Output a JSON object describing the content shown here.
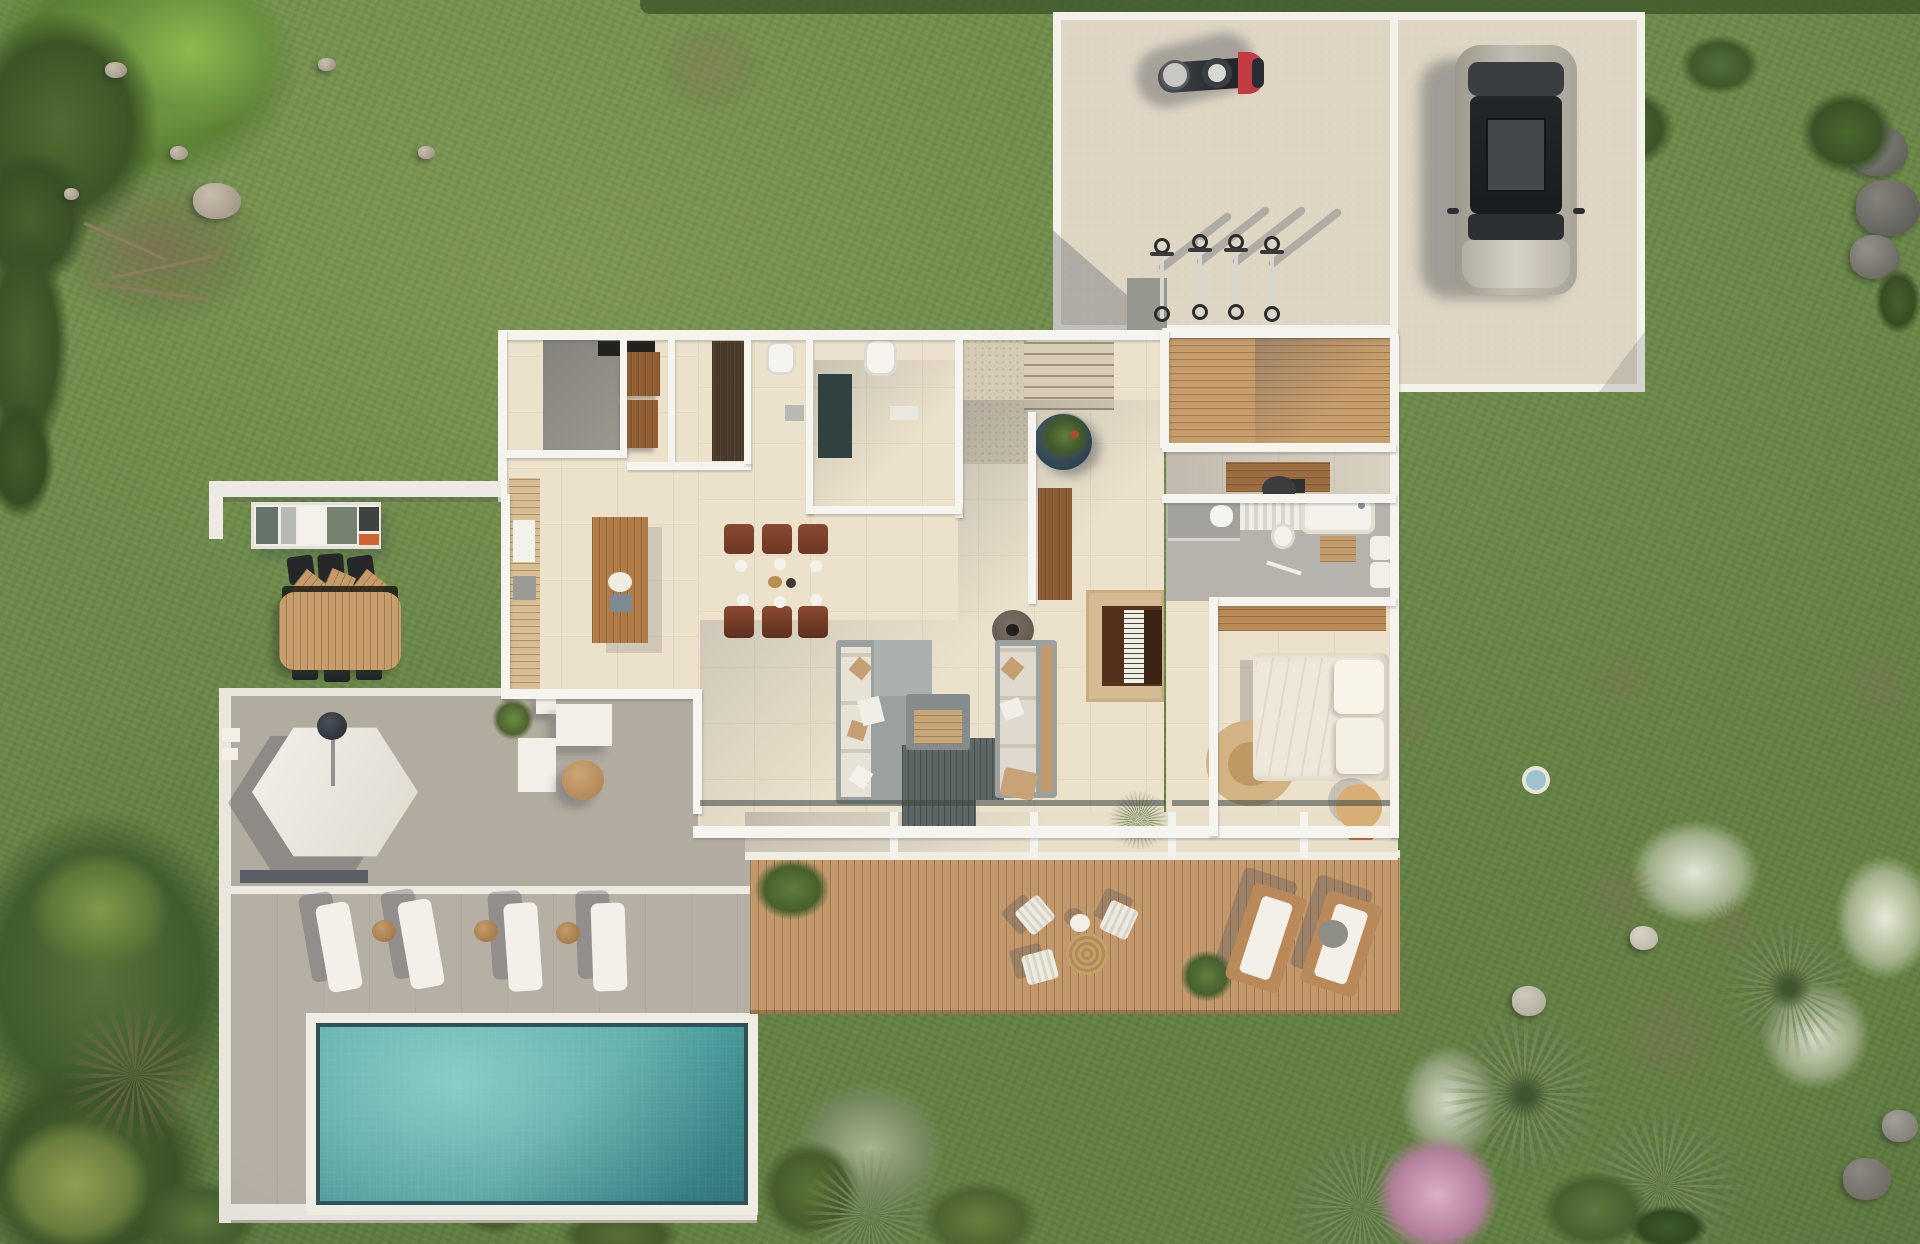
{
  "scene": {
    "title": "Aerial 3D render — modern villa floor plan with garden, pool, wood deck and parking court",
    "view": "top-down",
    "size": "1920x1244"
  },
  "palette": {
    "grass": "#6d8a4a",
    "grass_light": "#87a05a",
    "foliage_dark": "#42592c",
    "foliage_olive_silver": "#a7b591",
    "foliage_white_bloom": "#e2e7d8",
    "foliage_pink_bloom": "#dcaec7",
    "wall_white": "#f6f4ee",
    "interior_floor": "#ece2cc",
    "concrete_pad": "#ded5c3",
    "patio_concrete": "#b2ab9f",
    "deck_wood": "#c2986b",
    "furniture_wood": "#b07b44",
    "pool_water": "#4da3a0",
    "pool_water_light": "#8acbc3",
    "pool_coping": "#efece3",
    "accent_orange": "#d0642c",
    "sofa_gray": "#9ba19e",
    "cast_shadow": "rgba(70,76,88,0.34)"
  },
  "inventory": {
    "vehicles": {
      "car": 1,
      "motorcycle": 1,
      "bicycles": 4
    },
    "outdoor": {
      "pool": 1,
      "pool_sun_loungers": 4,
      "wicker_side_tables": 3,
      "hexagonal_umbrella": 1,
      "deck_folding_chairs": 3,
      "deck_wood_loungers": 2,
      "outdoor_kitchen_unit": 1,
      "garden_dining_table": 1,
      "garden_recliners": 3
    },
    "indoor": {
      "kitchen_island": 1,
      "dining_chairs": 6,
      "sofas": 2,
      "coffee_table": 1,
      "fire_bowl": 1,
      "piano": 1,
      "desk": 1,
      "office_chair": 1,
      "bathtub": 1,
      "toilet": 1,
      "double_bed": 1,
      "armchair": 1,
      "planter_pot": 1
    },
    "landscape": {
      "fan_palms": 5,
      "pink_flowering_tree": 1,
      "white_flowering_shrubs": 4,
      "rock_clusters": 3
    }
  }
}
